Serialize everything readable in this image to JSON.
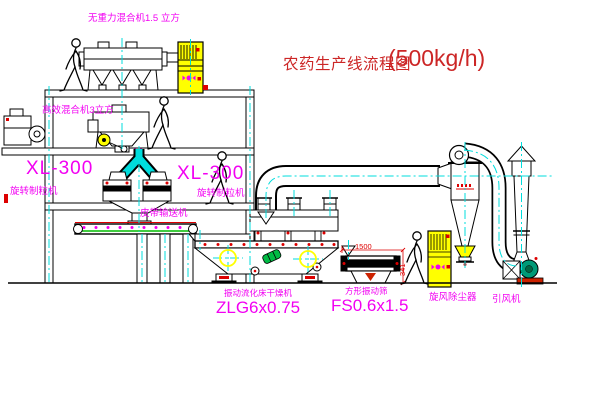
{
  "diagram": {
    "title": {
      "text": "农药生产线流程图",
      "capacity": "(500kg/h)"
    },
    "labels": {
      "gravity_free_mixer": "无重力混合机1.5 立方",
      "high_efficiency_mixer": "高效混合机3立方",
      "granulator_left_model": "XL-300",
      "granulator_left_name": "旋转制粒机",
      "granulator_right_model": "XL-300",
      "granulator_right_name": "旋转制粒机",
      "belt_conveyor": "皮带输送机",
      "dryer_name": "振动流化床干燥机",
      "dryer_model": "ZLG6x0.75",
      "sieve_name": "方形振动筛",
      "sieve_model": "FS0.6x1.5",
      "cyclone": "旋风除尘器",
      "fan": "引风机"
    },
    "dimensions": {
      "sieve_length": "1500",
      "sieve_height": "341"
    },
    "colors": {
      "label_magenta": "#f200f2",
      "title_red": "#cc2626",
      "centerline_cyan": "#00dddd",
      "equipment_yellow": "#ffff00",
      "dimension_red": "#dd0000",
      "belt_green": "#00bb00",
      "motor_teal": "#009977"
    }
  }
}
